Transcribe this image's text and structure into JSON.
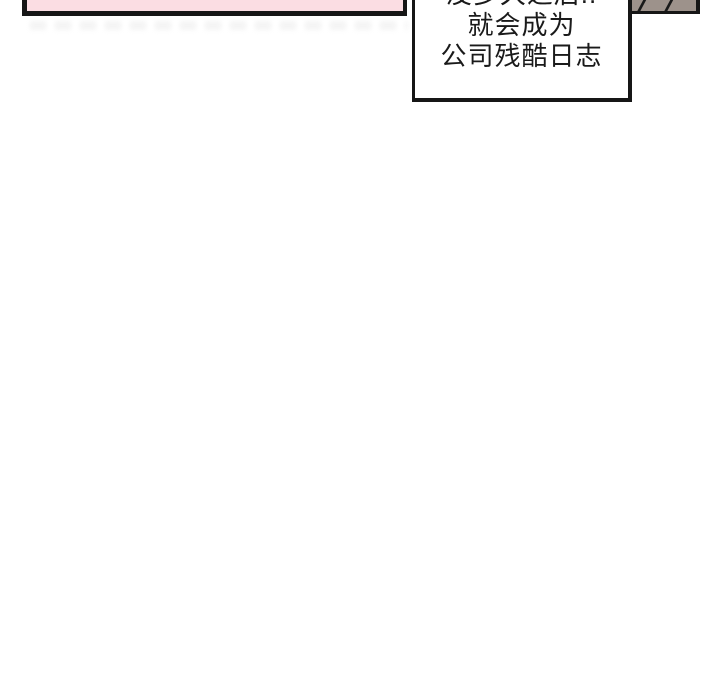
{
  "comic": {
    "speech_bubble": {
      "lines": {
        "0": "没多久之后..",
        "1": "就会成为",
        "2": "公司残酷日志"
      }
    },
    "colors": {
      "panel_pink": "#fbdde3",
      "ink": "#161616",
      "corner_object_taupe": "#9d928b",
      "paper": "#ffffff"
    }
  }
}
